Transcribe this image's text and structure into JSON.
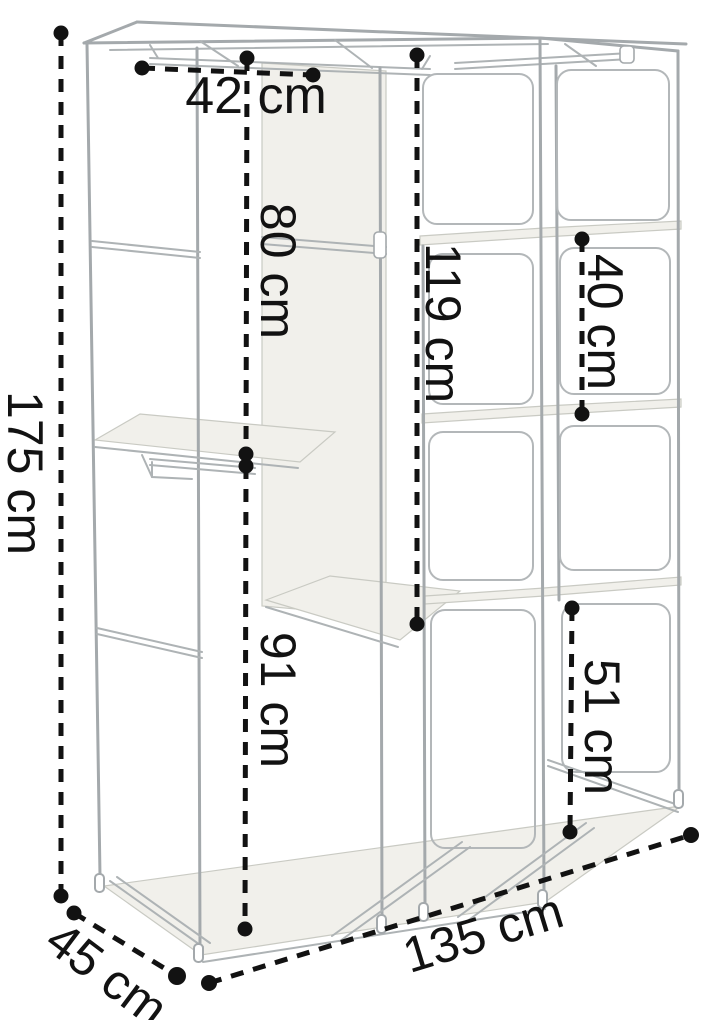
{
  "diagram": {
    "title": "Fabric wardrobe frame dimension diagram",
    "unit": "cm",
    "dimensions": {
      "total_height": {
        "label": "175 cm",
        "value": 175,
        "orientation": "vertical-left"
      },
      "left_section_width": {
        "label": "42 cm",
        "value": 42,
        "orientation": "horizontal-top"
      },
      "upper_left_height": {
        "label": "80 cm",
        "value": 80,
        "orientation": "vertical"
      },
      "lower_left_height": {
        "label": "91 cm",
        "value": 91,
        "orientation": "vertical"
      },
      "middle_section_height": {
        "label": "119 cm",
        "value": 119,
        "orientation": "vertical"
      },
      "upper_shelf_gap": {
        "label": "40 cm",
        "value": 40,
        "orientation": "vertical"
      },
      "lower_shelf_gap": {
        "label": "51 cm",
        "value": 51,
        "orientation": "vertical"
      },
      "depth": {
        "label": "45 cm",
        "value": 45,
        "orientation": "diagonal-bottom-left"
      },
      "total_width": {
        "label": "135 cm",
        "value": 135,
        "orientation": "diagonal-bottom"
      }
    },
    "colors": {
      "dimension_lines": "#121212",
      "frame_tubes": "#a4a9ac",
      "fabric_panels": "#f1f0eb",
      "background": "#ffffff"
    }
  }
}
